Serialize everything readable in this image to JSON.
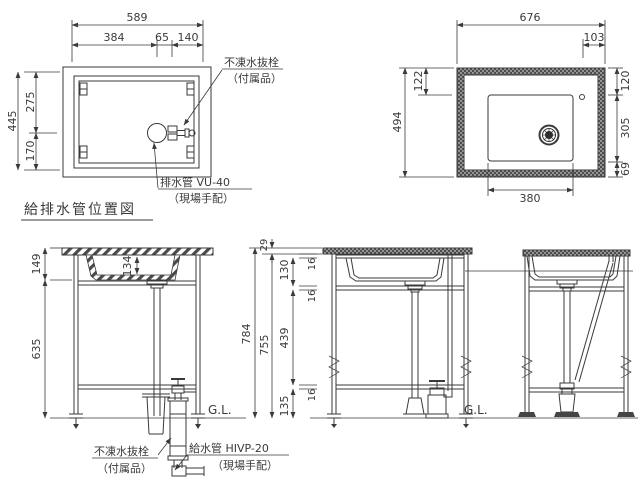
{
  "title": "給排水管位置図",
  "colors": {
    "line": "#3a3a3a",
    "background": "#ffffff"
  },
  "plan_view": {
    "dim_width_total": "589",
    "dim_width_left": "384",
    "dim_width_mid": "65",
    "dim_width_right": "140",
    "dim_height_total": "445",
    "dim_height_top": "275",
    "dim_height_bottom": "170",
    "freeze_valve_label": "不凍水抜栓",
    "freeze_valve_note": "（付属品）",
    "drain_pipe_label": "排水管 VU-40",
    "drain_pipe_note": "（現場手配）"
  },
  "top_view": {
    "dim_width_total": "676",
    "dim_faucet_offset": "103",
    "dim_height_total": "494",
    "dim_faucet_top": "122",
    "dim_right_top": "120",
    "dim_right_mid": "305",
    "dim_right_bottom": "69",
    "dim_basin_width": "380"
  },
  "front_view": {
    "dim_top": "149",
    "dim_leg": "635",
    "dim_basin_depth": "134",
    "ground_label": "G.L.",
    "freeze_valve_label": "不凍水抜栓",
    "freeze_valve_note": "（付属品）",
    "supply_pipe_label": "給水管 HIVP-20",
    "supply_pipe_note": "（現場手配）"
  },
  "side_view": {
    "dim_height_total": "784",
    "dim_counter_thickness": "29",
    "dim_below_counter": "755",
    "dim_upper": "130",
    "dim_middle": "439",
    "dim_lower": "135",
    "dim_rail": "16",
    "ground_label": "G.L."
  }
}
